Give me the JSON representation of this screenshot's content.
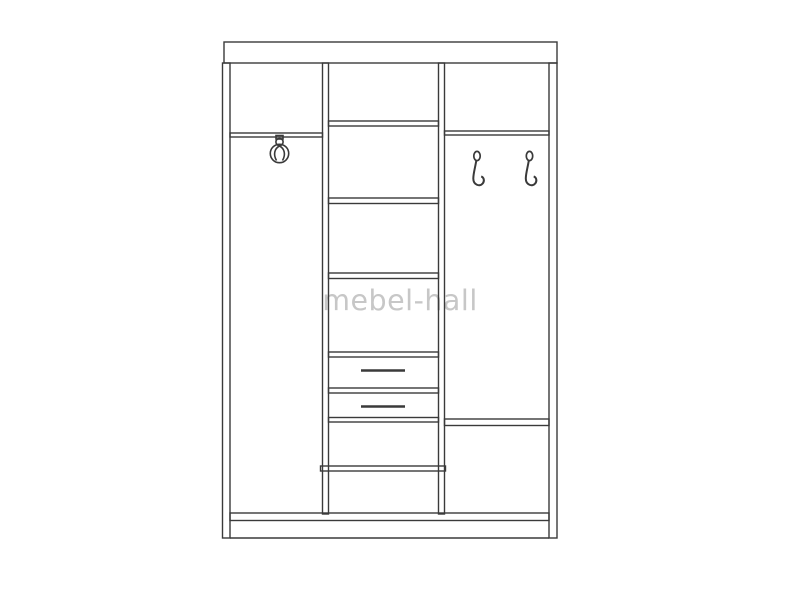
{
  "watermark": {
    "text": "mebel-hall",
    "color": "#c7c7c7"
  },
  "diagram": {
    "subject": "three-section wardrobe front elevation line drawing",
    "line_color": "#3a3a3a",
    "background_color": "#ffffff",
    "sections": {
      "left": {
        "label": "left wardrobe section",
        "features": [
          "top shelf",
          "swivel coat hook",
          "open hanging space"
        ]
      },
      "middle": {
        "label": "middle shelf column",
        "features": [
          "upper shelf",
          "shelf 2",
          "shelf 3",
          "drawer 1",
          "drawer 2",
          "lower shelf"
        ]
      },
      "right": {
        "label": "right wardrobe section",
        "features": [
          "top shelf",
          "coat hook 1",
          "coat hook 2",
          "lower shelf",
          "bottom compartment"
        ]
      }
    },
    "parts": [
      "top board",
      "left side panel",
      "right side panel",
      "left divider panel",
      "right divider panel",
      "bottom board",
      "plinth",
      "drawer handle 1",
      "drawer handle 2"
    ]
  }
}
